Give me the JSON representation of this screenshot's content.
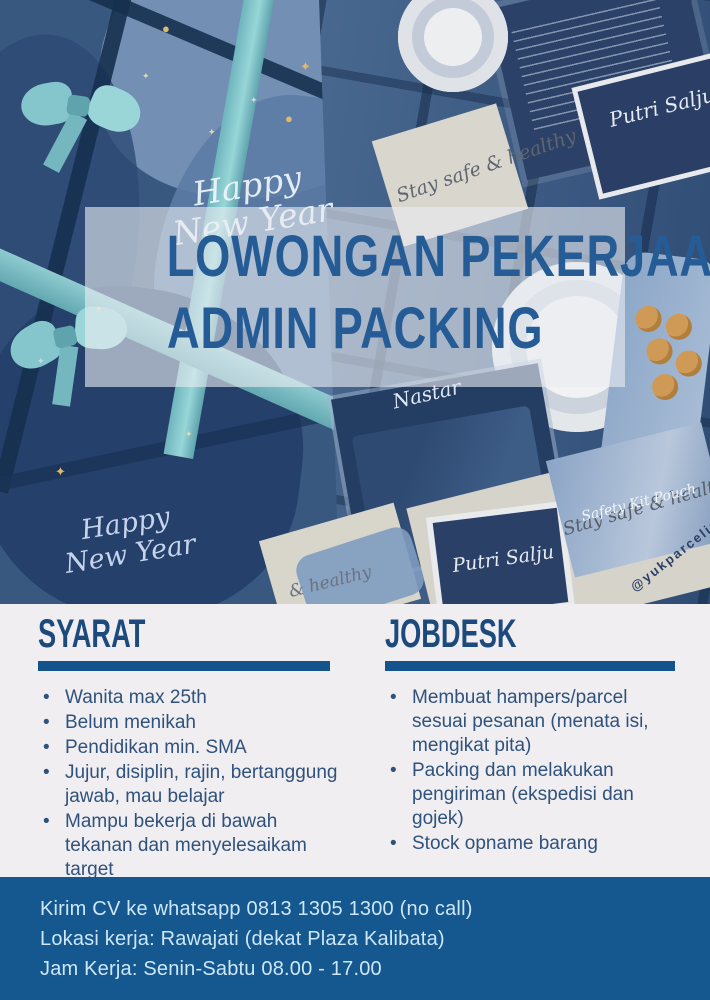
{
  "title": {
    "line1": "LOWONGAN PEKERJAAN",
    "line2": "ADMIN PACKING"
  },
  "photo_labels": {
    "happy_new_year_top": "Happy New Year",
    "happy_new_year_bottom": "Happy New Year",
    "stay_safe_top": "Stay safe & healthy",
    "stay_safe_right": "Stay safe & healthy",
    "healthy_partial": "& healthy",
    "nastar": "Nastar",
    "putri_salju_top": "Putri Salju",
    "putri_salju_bottom": "Putri Salju",
    "safety_kit_pouch": "Safety Kit Pouch",
    "instagram_handle": "@yukparcelinaja"
  },
  "sections": {
    "syarat": {
      "heading": "SYARAT",
      "items": [
        "Wanita max 25th",
        "Belum menikah",
        "Pendidikan min. SMA",
        "Jujur, disiplin, rajin, bertanggung jawab, mau belajar",
        "Mampu bekerja di bawah tekanan dan menyelesaikam target",
        "Harus bisa mengikat pita"
      ]
    },
    "jobdesk": {
      "heading": "JOBDESK",
      "items": [
        "Membuat hampers/parcel sesuai pesanan (menata isi, mengikat pita)",
        "Packing dan melakukan pengiriman (ekspedisi dan gojek)",
        "Stock opname barang"
      ]
    }
  },
  "footer": {
    "line1": "Kirim CV ke whatsapp 0813 1305 1300 (no call)",
    "line2": "Lokasi kerja: Rawajati (dekat Plaza Kalibata)",
    "line3": "Jam Kerja: Senin-Sabtu 08.00 - 17.00"
  },
  "colors": {
    "title_blue": "#265c96",
    "heading_blue": "#1c4a7c",
    "rule_blue": "#15538c",
    "body_text": "#2f527c",
    "footer_bg": "#15578f",
    "footer_text": "#cde7f6",
    "section_bg": "#f0eef1",
    "teal_ribbon": "#84c6cb",
    "navy_box": "#2b4067"
  }
}
